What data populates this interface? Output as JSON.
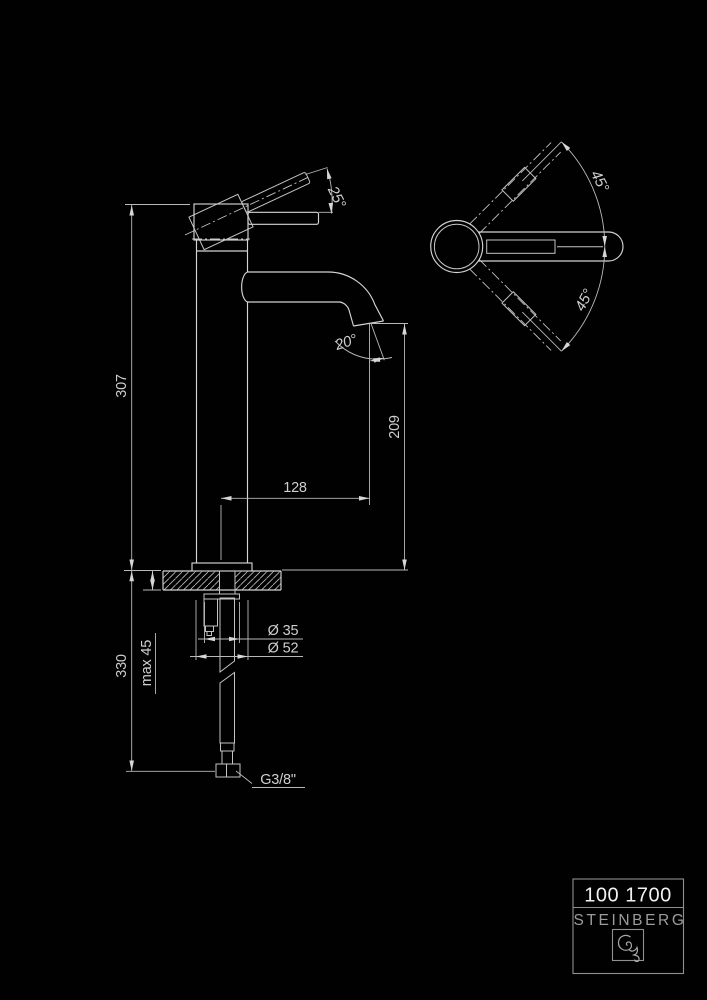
{
  "drawing": {
    "type": "technical-dimension-drawing",
    "product": "single-lever basin mixer, tall body",
    "colors": {
      "background": "#010101",
      "object_line": "#d4d4d4",
      "dimension_line": "#b9b9b9",
      "text": "#cfcfcf",
      "title_model": "#f2f2f2",
      "title_brand": "#9c9c9c",
      "title_frame": "#909090"
    },
    "side_view": {
      "labels": {
        "total_height": "307",
        "below_deck_height": "330",
        "deck_thickness": "max 45",
        "outlet_height": "209",
        "spout_reach": "128",
        "lever_lift_angle": "25°",
        "outlet_angle": "20°",
        "dia_escutcheon": "Ø 35",
        "dia_body": "Ø 52",
        "hose_connection": "G3/8\""
      }
    },
    "top_view": {
      "labels": {
        "lever_swivel_upper": "45°",
        "lever_swivel_lower": "45°"
      }
    },
    "title_block": {
      "model_number": "100 1700",
      "brand": "STEINBERG",
      "logo": "steinberg-squiggle-logo"
    }
  }
}
